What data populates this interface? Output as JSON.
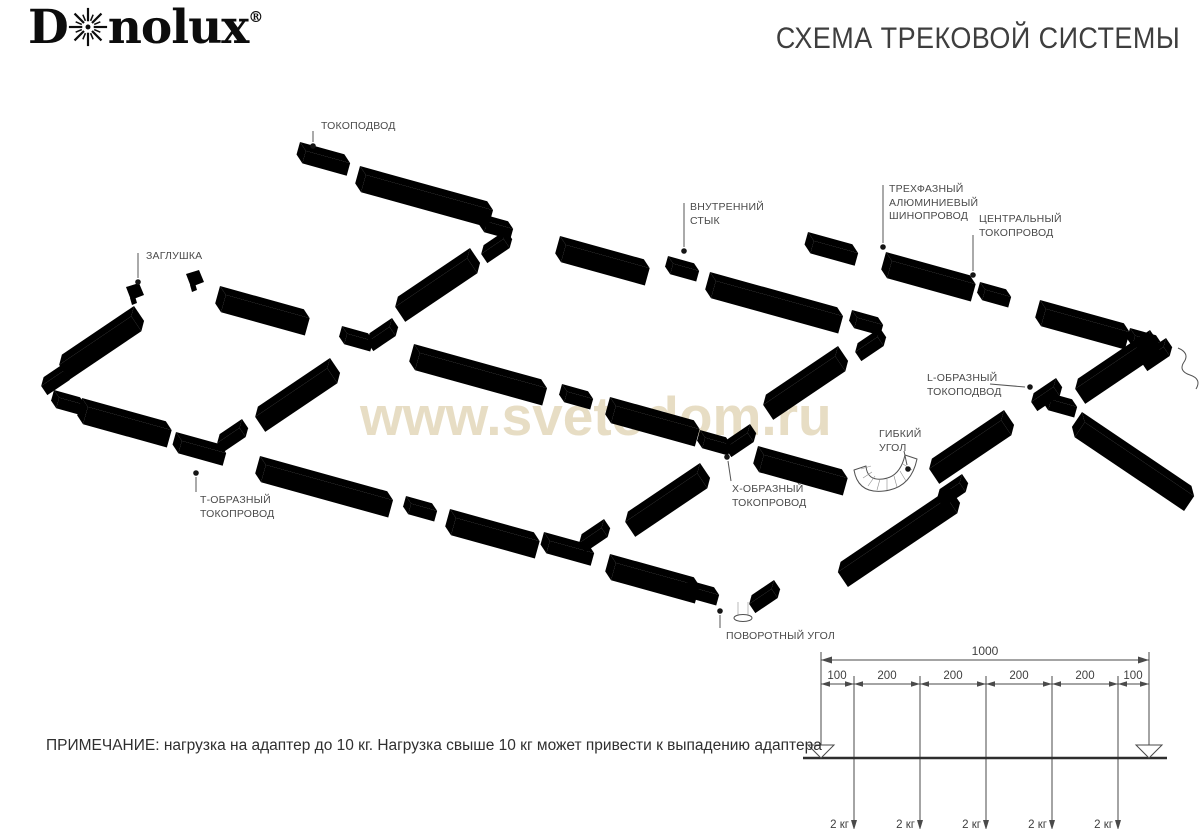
{
  "brand": {
    "logo_prefix": "D",
    "logo_suffix": "nolux",
    "registered": "®"
  },
  "header": {
    "title": "СХЕМА ТРЕКОВОЙ СИСТЕМЫ"
  },
  "watermark": {
    "text": "www.svetodom.ru",
    "color": "#e7ddc4"
  },
  "note": {
    "text": "ПРИМЕЧАНИЕ: нагрузка на адаптер до 10 кг. Нагрузка свыше 10 кг может привести к выпадению адаптера"
  },
  "diagram": {
    "labels": [
      {
        "id": "tokopodvod",
        "text": "ТОКОПОДВОД"
      },
      {
        "id": "zaglushka",
        "text": "ЗАГЛУШКА"
      },
      {
        "id": "vnutrenniy-styk",
        "text": "ВНУТРЕННИЙ\nСТЫК"
      },
      {
        "id": "trekhfazny-shinoprovod",
        "text": "ТРЕХФАЗНЫЙ\nАЛЮМИНИЕВЫЙ\nШИНОПРОВОД"
      },
      {
        "id": "tsentralny-tokoprovod",
        "text": "ЦЕНТРАЛЬНЫЙ\nТОКОПРОВОД"
      },
      {
        "id": "l-obrazny-tokopodvod",
        "text": "L-ОБРАЗНЫЙ\nТОКОПОДВОД"
      },
      {
        "id": "gibkiy-ugol",
        "text": "ГИБКИЙ\nУГОЛ"
      },
      {
        "id": "t-obrazny-tokoprovod",
        "text": "Т-ОБРАЗНЫЙ\nТОКОПРОВОД"
      },
      {
        "id": "x-obrazny-tokoprovod",
        "text": "Х-ОБРАЗНЫЙ\nТОКОПРОВОД"
      },
      {
        "id": "povorotny-ugol",
        "text": "ПОВОРОТНЫЙ УГОЛ"
      }
    ]
  },
  "load_diagram": {
    "total_dimension": "1000",
    "segment_dimensions": [
      "100",
      "200",
      "200",
      "200",
      "200",
      "100"
    ],
    "load_labels": [
      "2 кг",
      "2 кг",
      "2 кг",
      "2 кг",
      "2 кг"
    ]
  }
}
